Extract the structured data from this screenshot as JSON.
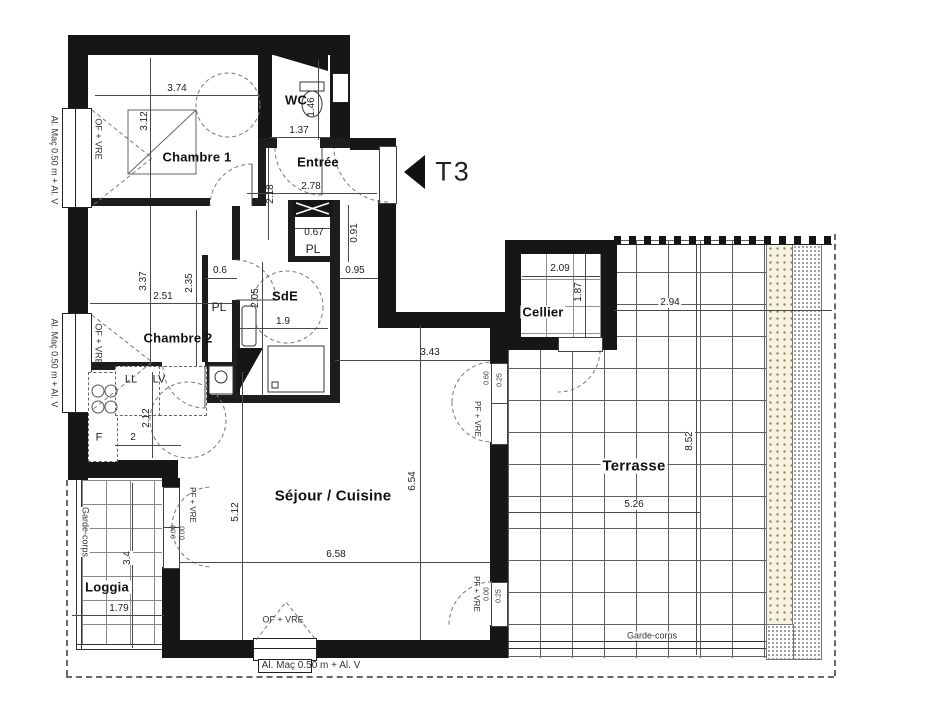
{
  "meta": {
    "type_label": "T3"
  },
  "rooms": {
    "chambre1": {
      "name": "Chambre 1"
    },
    "wc": {
      "name": "WC"
    },
    "entree": {
      "name": "Entrée"
    },
    "pl_entree": {
      "name": "PL"
    },
    "sde": {
      "name": "SdE"
    },
    "chambre2": {
      "name": "Chambre 2"
    },
    "pl_chambre2": {
      "name": "PL"
    },
    "sejour": {
      "name": "Séjour / Cuisine"
    },
    "loggia": {
      "name": "Loggia"
    },
    "cellier": {
      "name": "Cellier"
    },
    "terrasse": {
      "name": "Terrasse"
    }
  },
  "dims": {
    "chambre1_w": "3.74",
    "chambre1_h": "3.12",
    "wc_h": "1.46",
    "wc_w": "1.37",
    "entree_w": "2.78",
    "entree_h": "2.18",
    "pl_w": "0.67",
    "pl_h": "0.91",
    "corridor_w": "0.95",
    "sde_h": "2.05",
    "sde_w": "1.9",
    "chambre2_h1": "3.37",
    "chambre2_w": "2.51",
    "chambre2_h2": "2.35",
    "pl2_w": "0.6",
    "kitchen_h": "2.12",
    "kitchen_w": "2",
    "sejour_w": "6.58",
    "sejour_h": "6.54",
    "sejour_h2": "5.12",
    "sejour_w2": "3.43",
    "loggia_w": "1.79",
    "loggia_h": "3.4",
    "cellier_w": "2.09",
    "cellier_h": "1.87",
    "terrasse_w_top": "2.94",
    "terrasse_h": "8.52",
    "terrasse_w": "5.26",
    "door_terrace_up_a": "0.60",
    "door_terrace_up_b": "0.25",
    "door_terrace_low_a": "0.00",
    "door_terrace_low_b": "0.25",
    "door_loggia_a": "0.00",
    "door_loggia_b": "0.00"
  },
  "appliances": {
    "ll": "LL",
    "lv": "LV",
    "fridge": "F"
  },
  "annotations": {
    "alu_left_top": "Al. Maç 0.50 m + Al. V",
    "alu_left_bottom": "Al. Maç 0.50 m + Al. V",
    "alu_bottom": "Al. Maç 0.50 m + Al. V",
    "of_vre_left_top": "OF + VRE",
    "of_vre_left_bottom": "OF + VRE",
    "of_vre_bottom": "OF + VRE",
    "pf_vre_loggia": "PF + VRE",
    "pf_vre_terrace_up": "PF + VRE",
    "pf_vre_terrace_low": "PF + VRE",
    "garde_corps_loggia": "Garde-corps",
    "garde_corps_terrasse": "Garde-corps"
  }
}
